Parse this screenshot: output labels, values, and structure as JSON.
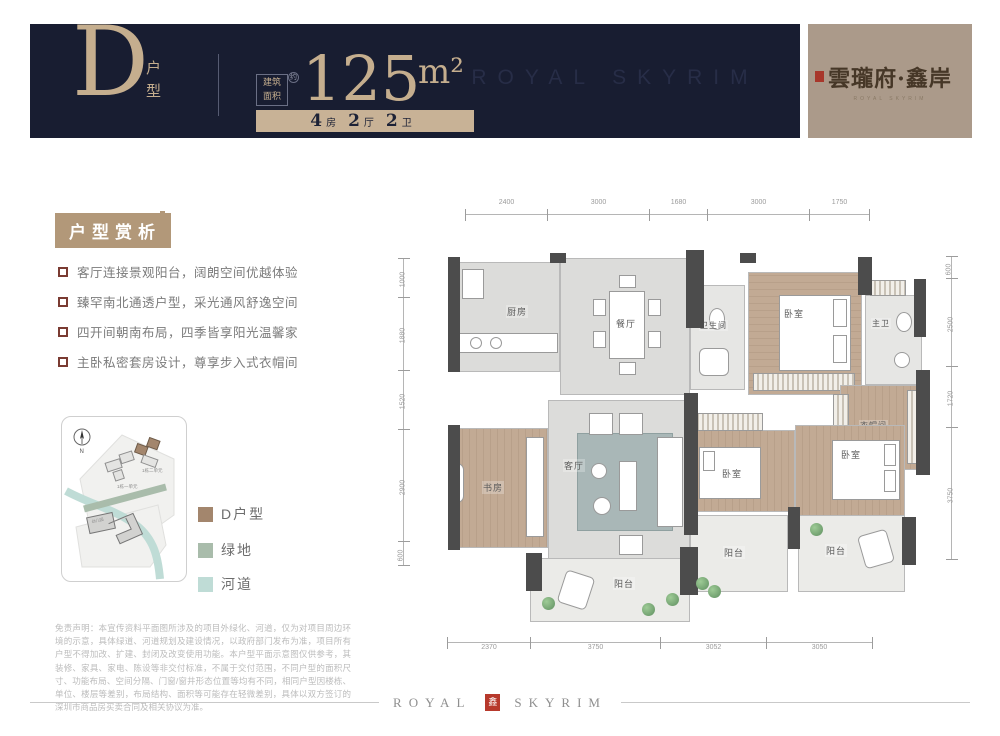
{
  "header": {
    "unit_letter": "D",
    "unit_type_vertical": "户型",
    "area_prefix_line1": "建筑",
    "area_prefix_line2": "面积",
    "area_about": "约",
    "area_value": "125",
    "area_unit": "m²",
    "spec": {
      "bedrooms_num": "4",
      "bedrooms_label": "房",
      "halls_num": "2",
      "halls_label": "厅",
      "baths_num": "2",
      "baths_label": "卫"
    },
    "watermark": "ROYAL SKYRIM",
    "colors": {
      "band_bg": "#181d31",
      "accent": "#c5ae8e"
    }
  },
  "brand": {
    "logo_text": "雲瓏府·鑫岸",
    "logo_sub": "ROYAL SKYRIM",
    "bg_color": "#ab9a8a",
    "seal_color": "#a8372b"
  },
  "analysis": {
    "title": "户型赏析",
    "bullets": [
      "客厅连接景观阳台，阔朗空间优越体验",
      "臻罕南北通透户型，采光通风舒逸空间",
      "四开间朝南布局，四季皆享阳光温馨家",
      "主卧私密套房设计，尊享步入式衣帽间"
    ]
  },
  "sitemap": {
    "north_label": "N",
    "building_label_1": "1栋一单元",
    "building_label_2": "1栋二单元",
    "building_label_3": "幼儿园",
    "legend": [
      {
        "label": "D户型",
        "color": "#a3866d"
      },
      {
        "label": "绿地",
        "color": "#a9bcab"
      },
      {
        "label": "河道",
        "color": "#bfdcd6"
      }
    ]
  },
  "disclaimer": "免责声明：本宣传资料平面图所涉及的项目外绿化、河道，仅为对项目周边环境的示意，具体绿道、河道规划及建设情况，以政府部门发布为准，项目所有户型不得加改、扩建、封闭及改变使用功能。本户型平面示意图仅供参考，其装修、家具、家电、陈设等非交付标准，不属于交付范围，不同户型的面积尺寸、功能布局、空间分隔、门窗/窗井形态位置等均有不同，相同户型因楼栋、单位、楼层等差别，布局结构、面积等可能存在轻微差别，具体以双方签订的深圳市商品房买卖合同及相关协议为准。",
  "floorplan": {
    "rooms": {
      "kitchen": "厨房",
      "dining": "餐厅",
      "bath": "卫生间",
      "bedroom_top": "卧室",
      "master_bath": "主卫",
      "closet": "衣帽间",
      "study": "书房",
      "living": "客厅",
      "bedroom_mid": "卧室",
      "bedroom_right": "卧室",
      "balcony_main": "阳台",
      "balcony_mid": "阳台",
      "balcony_right": "阳台"
    },
    "dims_top": [
      "2400",
      "3000",
      "1680",
      "3000",
      "1750"
    ],
    "dims_left": [
      "1000",
      "1880",
      "1520",
      "2900",
      "600"
    ],
    "dims_right": [
      "600",
      "2500",
      "1720",
      "3750"
    ],
    "dims_bottom": [
      "2370",
      "3750",
      "3052",
      "3050"
    ]
  },
  "footer": {
    "word_left": "ROYAL",
    "word_right": "SKYRIM",
    "seal_char": "鑫"
  }
}
